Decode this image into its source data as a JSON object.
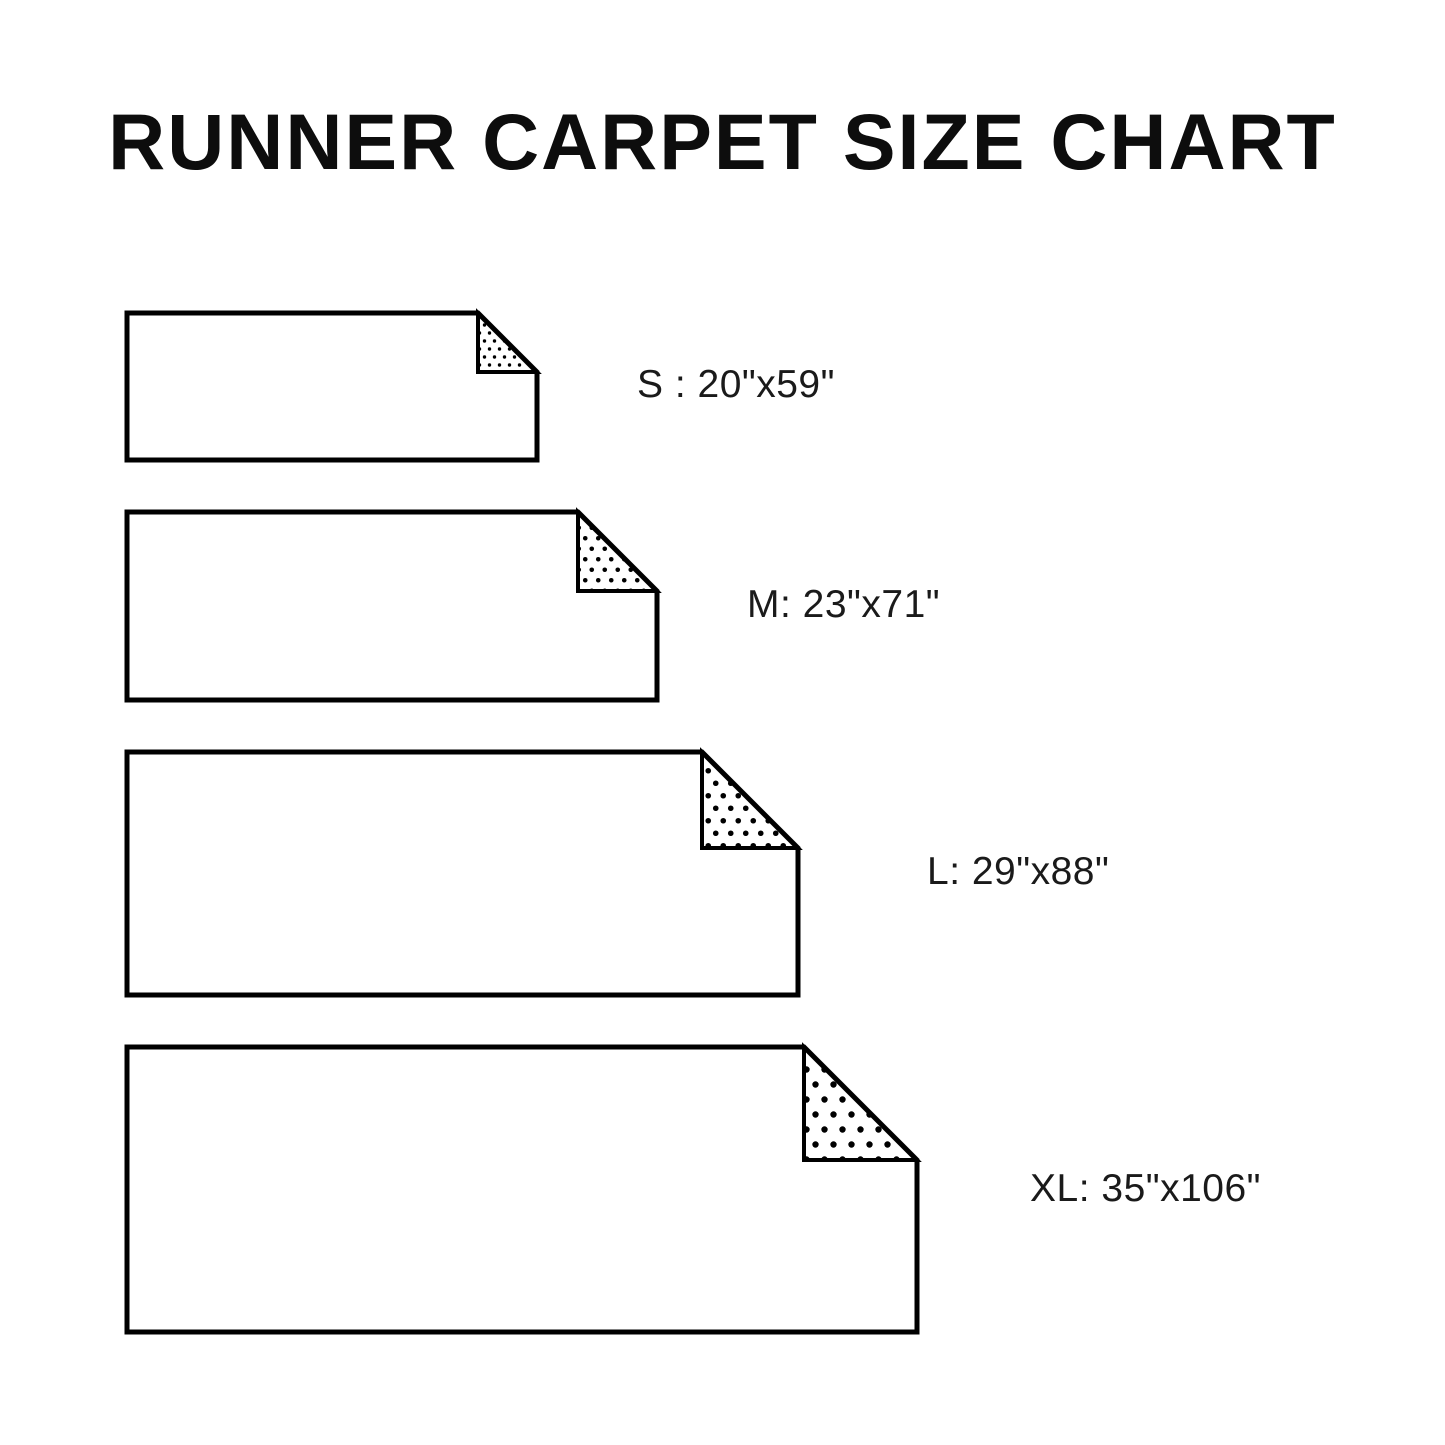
{
  "title": "RUNNER CARPET SIZE CHART",
  "colors": {
    "background": "#ffffff",
    "line": "#000000",
    "text": "#1a1a1a",
    "carpet_fill": "#ffffff"
  },
  "sizes": [
    {
      "code": "S",
      "label": "S : 20\"x59\"",
      "width_in": 20,
      "length_in": 59,
      "geometry": {
        "left": 127,
        "top": 313,
        "width": 410,
        "height": 147,
        "fold": 59,
        "dots": {
          "sx": 10,
          "sy": 16,
          "r": 1.7
        }
      },
      "label_pos": {
        "x": 637,
        "y": 386
      }
    },
    {
      "code": "M",
      "label": "M: 23\"x71\"",
      "width_in": 23,
      "length_in": 71,
      "geometry": {
        "left": 127,
        "top": 512,
        "width": 530,
        "height": 188,
        "fold": 79,
        "dots": {
          "sx": 13,
          "sy": 21,
          "r": 2.3
        }
      },
      "label_pos": {
        "x": 747,
        "y": 606
      }
    },
    {
      "code": "L",
      "label": "L: 29\"x88\"",
      "width_in": 29,
      "length_in": 88,
      "geometry": {
        "left": 127,
        "top": 752,
        "width": 671,
        "height": 243,
        "fold": 96,
        "dots": {
          "sx": 15,
          "sy": 25,
          "r": 2.8
        }
      },
      "label_pos": {
        "x": 927,
        "y": 873
      }
    },
    {
      "code": "XL",
      "label": "XL: 35\"x106\"",
      "width_in": 35,
      "length_in": 106,
      "geometry": {
        "left": 127,
        "top": 1047,
        "width": 790,
        "height": 285,
        "fold": 113,
        "dots": {
          "sx": 18,
          "sy": 30,
          "r": 3.2
        }
      },
      "label_pos": {
        "x": 1030,
        "y": 1190
      }
    }
  ],
  "stroke": {
    "outline_width": 5,
    "fold_width": 4
  }
}
